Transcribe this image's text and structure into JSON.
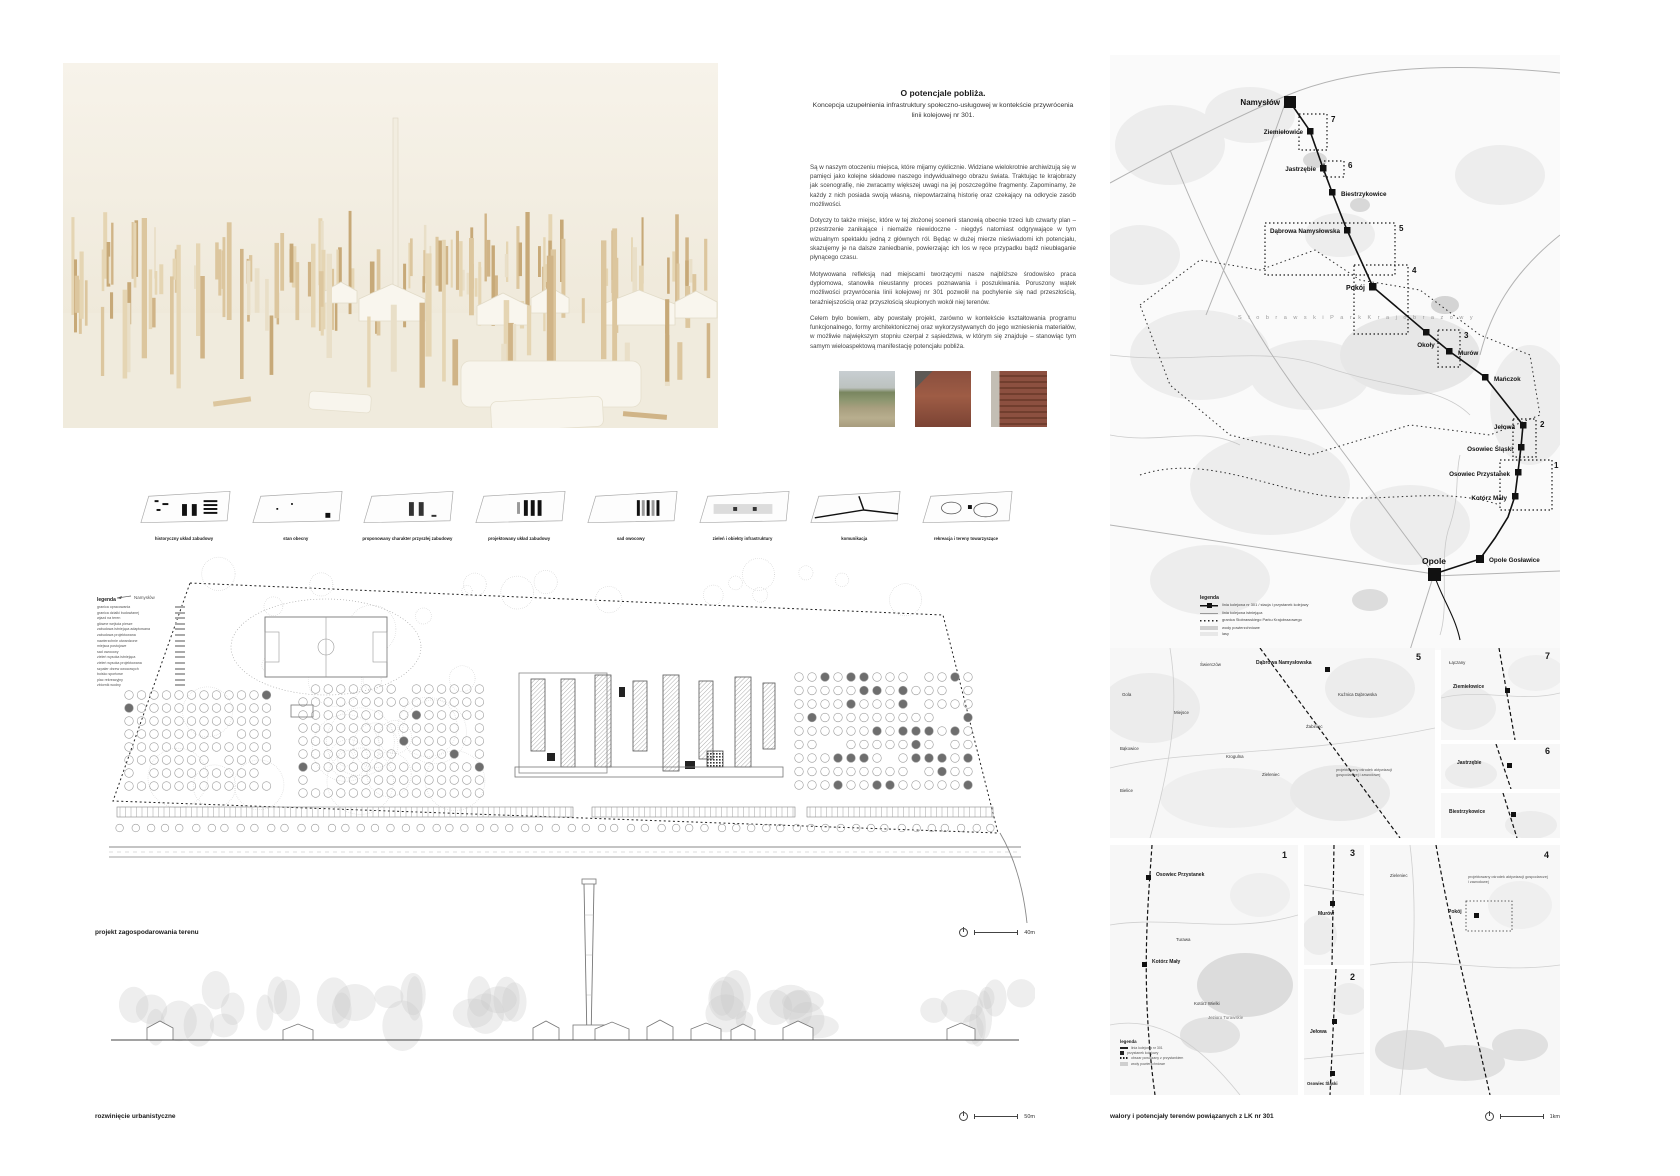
{
  "title_block": {
    "title": "O potencjale pobliża.",
    "subtitle": "Koncepcja uzupełnienia infrastruktury społeczno-usługowej w kontekście przywrócenia linii kolejowej nr 301.",
    "paragraphs": [
      "Są w naszym otoczeniu miejsca, które mijamy cyklicznie. Widziane wielokrotnie archiwizują się w pamięci jako kolejne składowe naszego indywidualnego obrazu świata. Traktując te krajobrazy jak scenografię, nie zwracamy większej uwagi na jej poszczególne fragmenty. Zapominamy, że każdy z nich posiada swoją własną, niepowtarzalną historię oraz czekający na odkrycie zasób możliwości.",
      "Dotyczy to także miejsc, które w tej złożonej scenerii stanowią obecnie trzeci lub czwarty plan – przestrzenie zanikające i niemalże niewidoczne - niegdyś natomiast odgrywające w tym wizualnym spektaklu jedną z głównych ról. Będąc w dużej mierze nieświadomi ich potencjału, skazujemy je na dalsze zaniedbanie, powierzając ich los w ręce przypadku bądź nieubłaganie płynącego czasu.",
      "Motywowana refleksją nad miejscami tworzącymi nasze najbliższe środowisko praca dyplomowa, stanowiła nieustanny proces poznawania i poszukiwania. Poruszony wątek możliwości przywrócenia linii kolejowej nr 301 pozwolił na pochylenie się nad przeszłością, teraźniejszością oraz przyszłością skupionych wokół niej terenów.",
      "Celem było bowiem, aby powstały projekt, zarówno w kontekście kształtowania programu funkcjonalnego, formy architektonicznej oraz wykorzystywanych do jego wzniesienia materiałów, w możliwie największym stopniu czerpał z sąsiedztwa, w którym się znajduje – stanowiąc tym samym wieloaspektową manifestację potencjału pobliża."
    ]
  },
  "diagram_strip": {
    "items": [
      {
        "label": "historyczny układ zabudowy"
      },
      {
        "label": "stan obecny"
      },
      {
        "label": "proponowany charakter przyszłej zabudowy"
      },
      {
        "label": "projektowany układ zabudowy"
      },
      {
        "label": "sad owocowy"
      },
      {
        "label": "zieleń i obiekty infrastruktury"
      },
      {
        "label": "komunikacja"
      },
      {
        "label": "rekreacja i tereny towarzyszące"
      }
    ]
  },
  "route_map": {
    "caption": "przebieg LK nr 301",
    "scale": "5km",
    "park_label": "S t o b r a w s k i   P a r k   K r a j o b r a z o w y",
    "legend_title": "legenda",
    "legend_items": [
      "linia kolejowa nr 301 / stacja i przystanek kolejowy",
      "linia kolejowa istniejąca",
      "granica Stobrawskiego Parku Krajobrazowego",
      "wody powierzchniowe",
      "lasy"
    ],
    "stations": [
      "Namysłów",
      "Ziemiełowice",
      "Jastrzębie",
      "Biestrzykowice",
      "Dąbrowa Namysłowska",
      "Pokój",
      "Okoły",
      "Murów",
      "Mańczok",
      "Jełowa",
      "Osowiec Śląski",
      "Osowiec Przystanek",
      "Kotórz Mały",
      "Opole Gosławice",
      "Opole"
    ],
    "areas": [
      "1",
      "2",
      "3",
      "4",
      "5",
      "6",
      "7"
    ]
  },
  "site_plan": {
    "caption": "projekt zagospodarowania terenu",
    "scale": "40m",
    "north_label": "Namysłów",
    "legend_title": "legenda",
    "legend_items": [
      "granica opracowania",
      "granica działki budowlanej",
      "wjazd na teren",
      "główne wejścia piesze",
      "zabudowa istniejąca adaptowana",
      "zabudowa projektowana",
      "nawierzchnie utwardzone",
      "miejsca postojowe",
      "sad owocowy",
      "zieleń wysoka istniejąca",
      "zieleń wysoka projektowana",
      "szpaler drzew owocowych",
      "boisko sportowe",
      "plac rekreacyjny",
      "zbiornik wodny"
    ]
  },
  "elevation": {
    "caption": "rozwinięcie urbanistyczne",
    "scale": "50m"
  },
  "detail_maps": {
    "caption": "walory i potencjały terenów powiązanych z LK nr 301",
    "scale": "1km",
    "note": "projektowany ośrodek aktywizacji gospodarczej i zawodowej",
    "panels": {
      "a5": {
        "number": "5",
        "station": "Dąbrowa Namysłowska",
        "villages": [
          "Świerczów",
          "Gola",
          "Miejsce",
          "Bąkowice",
          "Bielice",
          "Krogulna",
          "Zieleniec",
          "Żabiniec",
          "Kuźnica Dąbrowska"
        ]
      },
      "a7": {
        "number": "7",
        "labels": [
          "Łączany",
          "Ziemiełowice"
        ]
      },
      "a6": {
        "number": "6",
        "label": "Jastrzębie"
      },
      "ab": {
        "label": "Biestrzykowice"
      },
      "b1": {
        "number": "1",
        "labels": [
          "Osowiec Przystanek",
          "Turawa",
          "Kotórz Mały",
          "Kotórz Wielki",
          "Jezioro Turawskie"
        ],
        "legend_title": "legenda",
        "legend_items": [
          "linia kolejowa nr 301",
          "przystanek kolejowy",
          "obszar powiązany z przystankiem",
          "wody powierzchniowe"
        ]
      },
      "b3m": {
        "number": "3",
        "label": "Murów"
      },
      "b2m": {
        "number": "2",
        "labels": [
          "Jełowa",
          "Osowiec Śląski"
        ]
      },
      "b4": {
        "number": "4",
        "labels": [
          "Zieleniec",
          "Pokój"
        ]
      }
    }
  }
}
